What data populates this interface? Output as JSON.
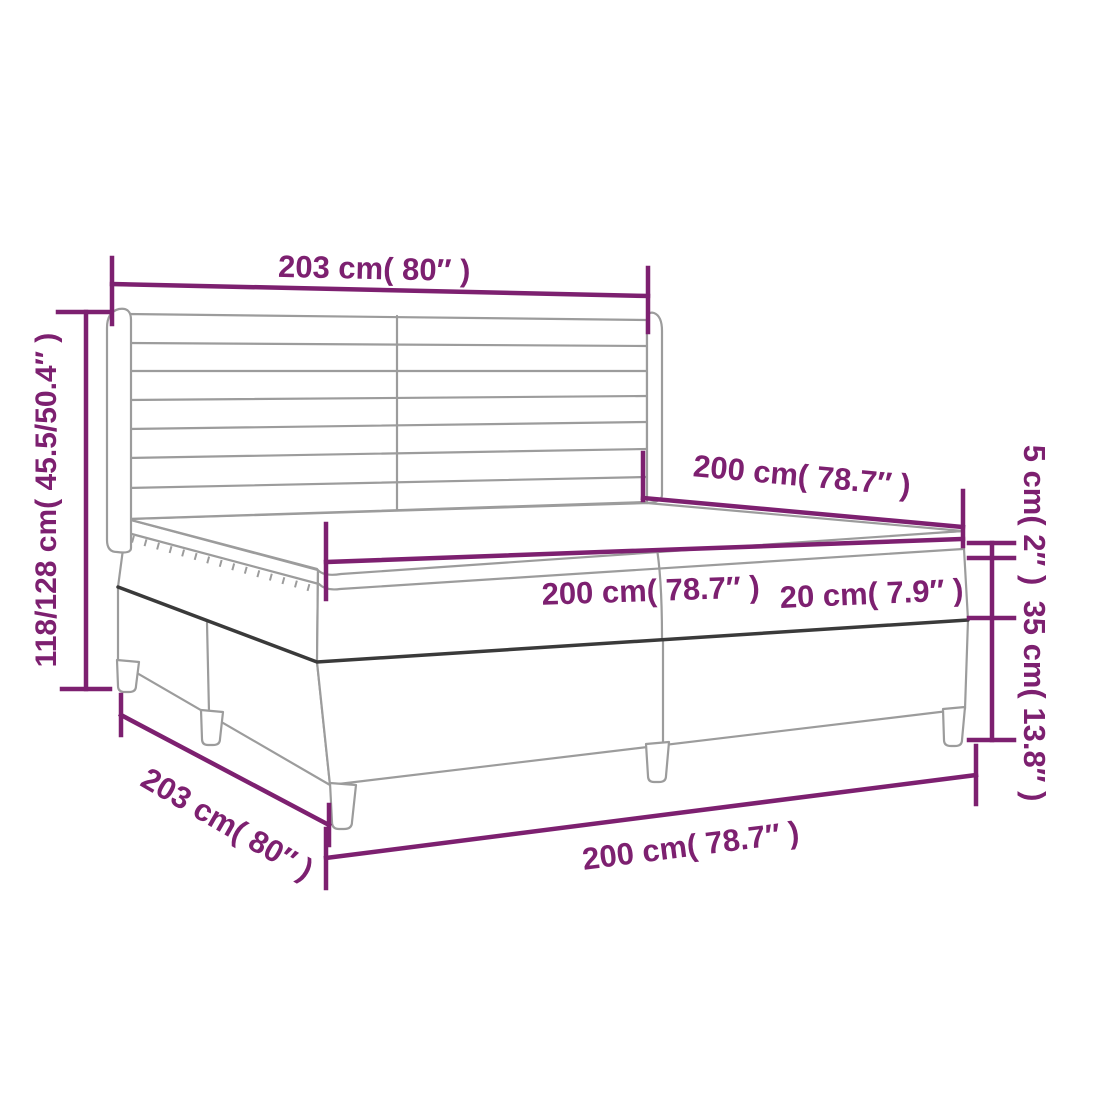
{
  "colors": {
    "dimension": "#7D2070",
    "outline": "#9C9C9C",
    "seam": "#3A3A3A",
    "background": "#FFFFFF"
  },
  "dimensions": {
    "headboard_width": "203 cm( 80″ )",
    "total_height": "118/128 cm( 45.5/50.4″ )",
    "mattress_length": "200 cm( 78.7″ )",
    "mattress_width": "200 cm( 78.7″ )",
    "mattress_height": "20 cm( 7.9″ )",
    "topper_height": "5 cm( 2″ )",
    "base_height": "35 cm( 13.8″ )",
    "frame_length": "203 cm( 80″ )",
    "base_width": "200 cm( 78.7″ )"
  }
}
